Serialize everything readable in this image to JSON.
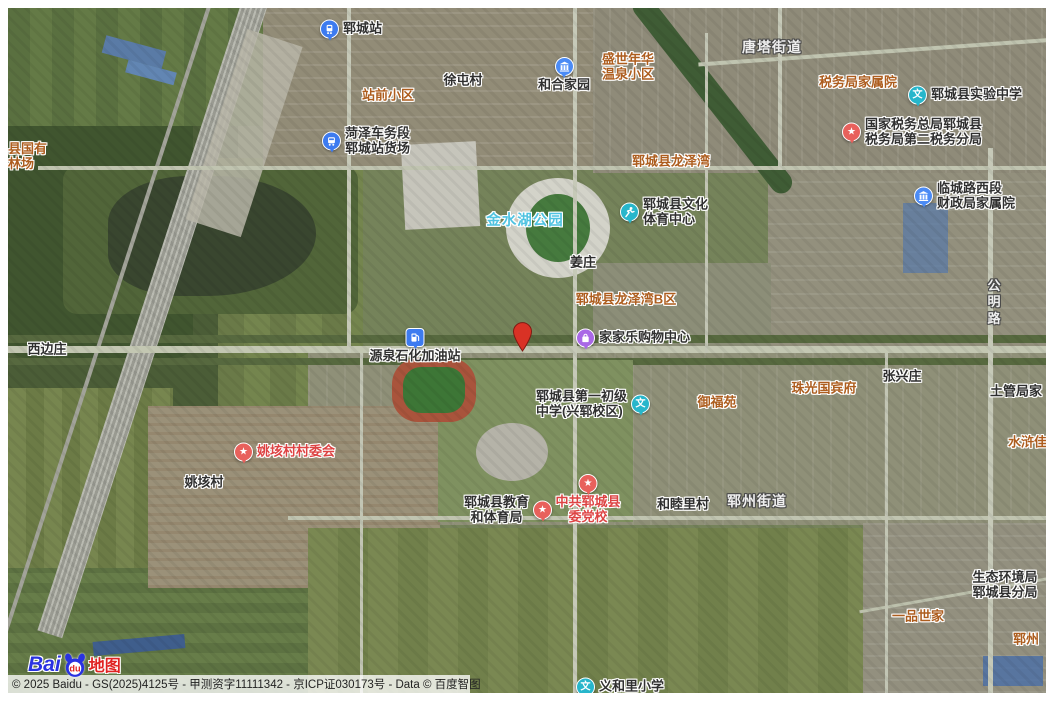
{
  "map": {
    "copyright": "© 2025 Baidu - GS(2025)4125号 - 甲测资字11111342 - 京ICP证030173号 - Data © 百度智图",
    "logo": {
      "bai": "Bai",
      "du": "du",
      "suffix": "地图"
    },
    "palette": {
      "aoi": "#ad5d1e",
      "poi": "#303030",
      "village": "#2e2e2e",
      "red": "#dd4343",
      "park": "#4fc3e1",
      "town": "#efefef",
      "road": "#efefef"
    },
    "icon_colors": {
      "train": "#3d7bf0",
      "bus": "#3d7bf0",
      "building": "#4b8bf5",
      "school": "#27b6cb",
      "sports": "#27b6cb",
      "star": "#e8615c",
      "shop": "#a968e6",
      "fuel": "#3d7bf0"
    },
    "marker": {
      "name": "destination-marker",
      "x": 504,
      "y": 314,
      "fill": "#d93225",
      "stroke": "#801912"
    },
    "labels": [
      {
        "name": "poi-yuncheng-station",
        "kind": "poi",
        "icon": "train",
        "layout": "row",
        "anchor": "l",
        "x": 312,
        "y": 21,
        "lines": [
          "郓城站"
        ],
        "interactable": true
      },
      {
        "name": "poi-heze-freight-yard",
        "kind": "poi",
        "icon": "bus",
        "layout": "row",
        "anchor": "l",
        "x": 314,
        "y": 133,
        "lines": [
          "菏泽车务段",
          "郓城站货场"
        ],
        "talign": "l",
        "interactable": true
      },
      {
        "name": "aoi-zhanqian-xiaoqu",
        "kind": "aoi",
        "layout": "col",
        "anchor": "c",
        "x": 380,
        "y": 88,
        "lines": [
          "站前小区"
        ],
        "interactable": false
      },
      {
        "name": "village-xutuncun",
        "kind": "village",
        "layout": "col",
        "anchor": "c",
        "x": 455,
        "y": 73,
        "lines": [
          "徐屯村"
        ],
        "interactable": false
      },
      {
        "name": "poi-hehe-jiayuan",
        "kind": "poi",
        "icon": "building",
        "layout": "col",
        "anchor": "tc",
        "x": 556,
        "y": 49,
        "lines": [
          "和合家园"
        ],
        "interactable": true
      },
      {
        "name": "aoi-shengshi-nianhua",
        "kind": "aoi",
        "layout": "col",
        "anchor": "c",
        "x": 620,
        "y": 59,
        "lines": [
          "盛世年华",
          "温泉小区"
        ],
        "talign": "c",
        "interactable": false
      },
      {
        "name": "town-tangta-jiedao",
        "kind": "town",
        "layout": "col",
        "anchor": "c",
        "x": 764,
        "y": 40,
        "lines": [
          "唐塔街道"
        ],
        "interactable": false
      },
      {
        "name": "aoi-shuiwuju-jiashuyuan",
        "kind": "aoi",
        "layout": "col",
        "anchor": "c",
        "x": 850,
        "y": 75,
        "lines": [
          "税务局家属院"
        ],
        "interactable": false
      },
      {
        "name": "poi-shiyan-zhongxue",
        "kind": "poi",
        "icon": "school",
        "layout": "row",
        "anchor": "l",
        "x": 900,
        "y": 87,
        "lines": [
          "郓城县实验中学"
        ],
        "interactable": true
      },
      {
        "name": "poi-guojia-shuiwu",
        "kind": "poi",
        "icon": "star",
        "layout": "row",
        "anchor": "l",
        "x": 834,
        "y": 124,
        "lines": [
          "国家税务总局郓城县",
          "税务局第二税务分局"
        ],
        "talign": "l",
        "interactable": true
      },
      {
        "name": "poi-caizhengju-jiashuyuan",
        "kind": "poi",
        "icon": "building",
        "layout": "row",
        "anchor": "l",
        "x": 906,
        "y": 188,
        "lines": [
          "临城路西段",
          "财政局家属院"
        ],
        "talign": "l",
        "interactable": true
      },
      {
        "name": "aoi-longzewan",
        "kind": "aoi",
        "layout": "col",
        "anchor": "c",
        "x": 663,
        "y": 154,
        "lines": [
          "郓城县龙泽湾"
        ],
        "interactable": false
      },
      {
        "name": "park-jinshuihu",
        "kind": "park",
        "layout": "col",
        "anchor": "c",
        "x": 517,
        "y": 213,
        "lines": [
          "金水湖公园"
        ],
        "interactable": false
      },
      {
        "name": "poi-wenhua-tiyu-zhongxin",
        "kind": "poi",
        "icon": "sports",
        "layout": "row",
        "anchor": "l",
        "x": 612,
        "y": 204,
        "lines": [
          "郓城县文化",
          "体育中心"
        ],
        "talign": "l",
        "interactable": true
      },
      {
        "name": "village-jiangzhuang",
        "kind": "village",
        "layout": "col",
        "anchor": "c",
        "x": 575,
        "y": 255,
        "lines": [
          "姜庄"
        ],
        "interactable": false
      },
      {
        "name": "aoi-longzewan-bqu",
        "kind": "aoi",
        "layout": "col",
        "anchor": "c",
        "x": 618,
        "y": 292,
        "lines": [
          "郓城县龙泽湾B区"
        ],
        "interactable": false
      },
      {
        "name": "road-gongminglu",
        "kind": "road",
        "layout": "col",
        "anchor": "tc",
        "x": 986,
        "y": 270,
        "lines": [
          "公",
          "明",
          "路"
        ],
        "interactable": false
      },
      {
        "name": "village-xibianzhuang",
        "kind": "village",
        "layout": "col",
        "anchor": "c",
        "x": 39,
        "y": 342,
        "lines": [
          "西边庄"
        ],
        "interactable": false
      },
      {
        "name": "poi-yuanquan-jiayouzhan",
        "kind": "poi",
        "icon": "fuel",
        "layout": "col",
        "anchor": "tc",
        "x": 407,
        "y": 320,
        "lines": [
          "源泉石化加油站"
        ],
        "interactable": true
      },
      {
        "name": "poi-jiajiale-gouwu",
        "kind": "poi",
        "icon": "shop",
        "layout": "row",
        "anchor": "l",
        "x": 568,
        "y": 330,
        "lines": [
          "家家乐购物中心"
        ],
        "interactable": true
      },
      {
        "name": "poi-diyi-chuji-zhongxue",
        "kind": "poi",
        "icon": "school",
        "layout": "row-rev",
        "anchor": "l",
        "x": 528,
        "y": 396,
        "lines": [
          "郓城县第一初级",
          "中学(兴郓校区)"
        ],
        "talign": "l",
        "interactable": true
      },
      {
        "name": "aoi-yufuyuan",
        "kind": "aoi",
        "layout": "col",
        "anchor": "c",
        "x": 709,
        "y": 395,
        "lines": [
          "御福苑"
        ],
        "interactable": false
      },
      {
        "name": "aoi-zhuguang-guobinfu",
        "kind": "aoi",
        "layout": "col",
        "anchor": "c",
        "x": 816,
        "y": 381,
        "lines": [
          "珠光国宾府"
        ],
        "interactable": false
      },
      {
        "name": "village-zhangxingzhuang",
        "kind": "village",
        "layout": "col",
        "anchor": "c",
        "x": 894,
        "y": 369,
        "lines": [
          "张兴庄"
        ],
        "interactable": false
      },
      {
        "name": "village-tuguanju-jia",
        "kind": "village",
        "layout": "col",
        "anchor": "l",
        "x": 982,
        "y": 384,
        "lines": [
          "土管局家"
        ],
        "interactable": false
      },
      {
        "name": "aoi-shuihu-jiayuan",
        "kind": "aoi",
        "layout": "col",
        "anchor": "l",
        "x": 1000,
        "y": 435,
        "lines": [
          "水浒佳苑"
        ],
        "interactable": false
      },
      {
        "name": "poi-yaogaicun-weihui",
        "kind": "red",
        "icon": "star",
        "layout": "row",
        "anchor": "l",
        "x": 226,
        "y": 444,
        "lines": [
          "姚垓村村委会"
        ],
        "interactable": true
      },
      {
        "name": "village-yaogaicun",
        "kind": "village",
        "layout": "col",
        "anchor": "c",
        "x": 196,
        "y": 475,
        "lines": [
          "姚垓村"
        ],
        "interactable": false
      },
      {
        "name": "poi-jiaoyu-tiyuju",
        "kind": "poi",
        "icon": "star",
        "layout": "row-rev",
        "anchor": "l",
        "x": 456,
        "y": 502,
        "lines": [
          "郓城县教育",
          "和体育局"
        ],
        "talign": "c",
        "interactable": true
      },
      {
        "name": "poi-weidangxiao",
        "kind": "red",
        "icon": "star",
        "layout": "col",
        "anchor": "tc",
        "x": 580,
        "y": 466,
        "lines": [
          "中共郓城县",
          "委党校"
        ],
        "talign": "c",
        "interactable": true
      },
      {
        "name": "village-hemulicun",
        "kind": "village",
        "layout": "col",
        "anchor": "c",
        "x": 675,
        "y": 497,
        "lines": [
          "和睦里村"
        ],
        "interactable": false
      },
      {
        "name": "town-yunzhou-jiedao",
        "kind": "town",
        "layout": "col",
        "anchor": "c",
        "x": 749,
        "y": 494,
        "lines": [
          "郓州街道"
        ],
        "interactable": false
      },
      {
        "name": "aoi-guoyou-linchang",
        "kind": "aoi",
        "layout": "col",
        "anchor": "tl",
        "x": 0,
        "y": 134,
        "lines": [
          "县国有",
          "林场"
        ],
        "talign": "l",
        "interactable": false
      },
      {
        "name": "poi-shengtai-huanjingju",
        "kind": "poi",
        "layout": "col",
        "anchor": "c",
        "x": 997,
        "y": 577,
        "lines": [
          "生态环境局",
          "郓城县分局"
        ],
        "talign": "c",
        "interactable": true
      },
      {
        "name": "aoi-yipin-shijia",
        "kind": "aoi",
        "layout": "col",
        "anchor": "c",
        "x": 910,
        "y": 609,
        "lines": [
          "一品世家"
        ],
        "interactable": false
      },
      {
        "name": "aoi-yunzhou-cut",
        "kind": "aoi",
        "layout": "col",
        "anchor": "l",
        "x": 1005,
        "y": 632,
        "lines": [
          "郓州"
        ],
        "interactable": false
      },
      {
        "name": "poi-yihelixiaoxue",
        "kind": "poi",
        "icon": "school",
        "layout": "row",
        "anchor": "l",
        "x": 568,
        "y": 679,
        "lines": [
          "义和里小学"
        ],
        "interactable": true
      }
    ]
  }
}
